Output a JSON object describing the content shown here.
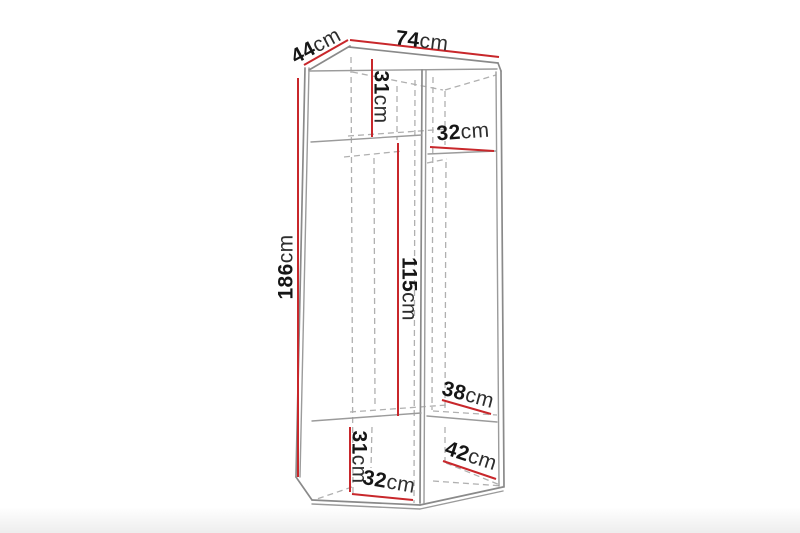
{
  "figure": {
    "type": "furniture-dimension-diagram",
    "subject": "two-door wardrobe line drawing with interior shelves",
    "units": "cm"
  },
  "colors": {
    "background": "#ffffff",
    "dimension_line": "#c8272b",
    "visible_edge": "#8a8a8a",
    "hidden_edge": "#b0b0b0",
    "label_text": "#161616"
  },
  "dimensions": {
    "depth_top": {
      "value": "44",
      "unit": "cm",
      "meaning": "overall depth (top left edge)"
    },
    "width_top": {
      "value": "74",
      "unit": "cm",
      "meaning": "overall width (top edge)"
    },
    "upper_section": {
      "value": "31",
      "unit": "cm",
      "meaning": "upper left compartment height"
    },
    "right_upper_shelf": {
      "value": "32",
      "unit": "cm",
      "meaning": "right compartment upper shelf"
    },
    "total_height": {
      "value": "186",
      "unit": "cm",
      "meaning": "overall height (left side)"
    },
    "middle_section": {
      "value": "115",
      "unit": "cm",
      "meaning": "middle hanging section height"
    },
    "right_lower_shelf": {
      "value": "38",
      "unit": "cm",
      "meaning": "right compartment lower shelf"
    },
    "lower_section": {
      "value": "31",
      "unit": "cm",
      "meaning": "lower left compartment height"
    },
    "bottom_left_shelf": {
      "value": "32",
      "unit": "cm",
      "meaning": "bottom shelf width, left compartment"
    },
    "bottom_right_shelf": {
      "value": "42",
      "unit": "cm",
      "meaning": "bottom shelf width, right compartment"
    }
  }
}
